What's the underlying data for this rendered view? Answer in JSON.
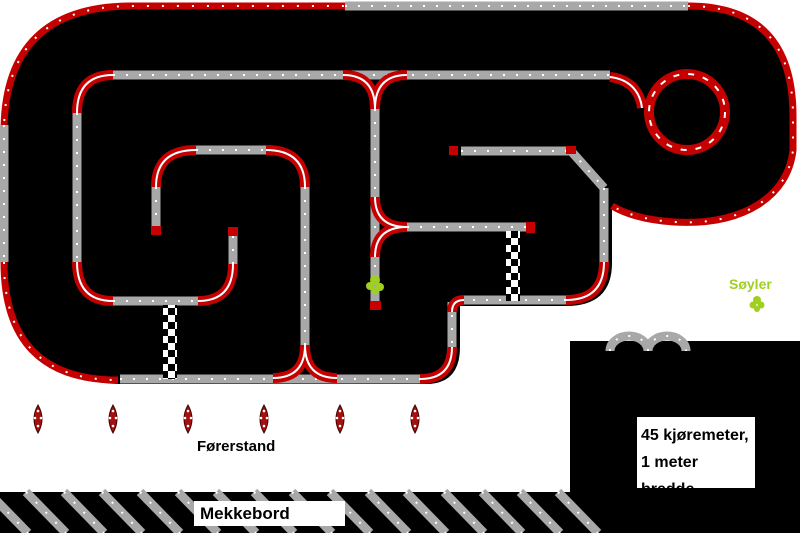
{
  "title": "RC-bane plantegning",
  "colors": {
    "background": "#ffffff",
    "surface_black": "#000000",
    "track_gray": "#a8a8a8",
    "curb_red": "#c40000",
    "marker_red": "#a81010",
    "pillar_green": "#9fd020"
  },
  "labels": {
    "pillars": "Søyler",
    "driver_stand": "Førerstand",
    "work_bench": "Mekkebord",
    "info_line1": "45 kjøremeter,",
    "info_line2": "1 meter bredde"
  },
  "markers": {
    "driver_positions": 6,
    "pillar_markers": 2,
    "start_finish_checkers": 2,
    "loops": 1
  }
}
